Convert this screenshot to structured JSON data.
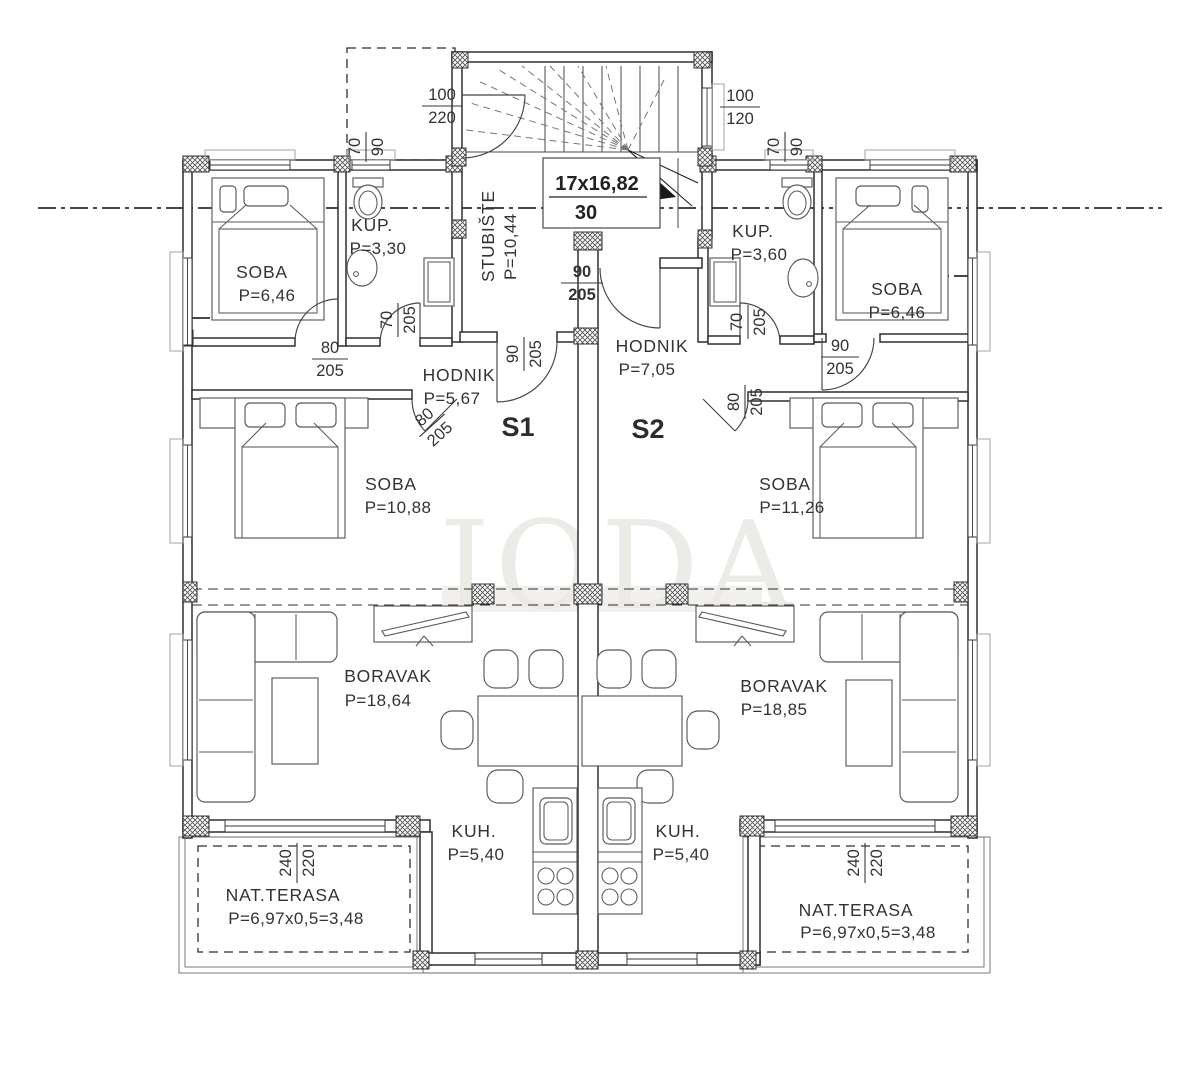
{
  "plan": {
    "watermark": "JODA",
    "stairwell": {
      "name": "STUBIŠTE",
      "area": "P=10,44",
      "steps": "17x16,82",
      "step_width": "30"
    },
    "unit1": {
      "id": "S1",
      "soba_small": {
        "name": "SOBA",
        "area": "P=6,46"
      },
      "kup": {
        "name": "KUP.",
        "area": "P=3,30"
      },
      "hodnik": {
        "name": "HODNIK",
        "area": "P=5,67"
      },
      "soba": {
        "name": "SOBA",
        "area": "P=10,88"
      },
      "boravak": {
        "name": "BORAVAK",
        "area": "P=18,64"
      },
      "kuh": {
        "name": "KUH.",
        "area": "P=5,40"
      },
      "terasa": {
        "name": "NAT.TERASA",
        "area": "P=6,97x0,5=3,48"
      }
    },
    "unit2": {
      "id": "S2",
      "kup": {
        "name": "KUP.",
        "area": "P=3,60"
      },
      "hodnik": {
        "name": "HODNIK",
        "area": "P=7,05"
      },
      "soba_small": {
        "name": "SOBA",
        "area": "P=6,46"
      },
      "soba": {
        "name": "SOBA",
        "area": "P=11,26"
      },
      "boravak": {
        "name": "BORAVAK",
        "area": "P=18,85"
      },
      "kuh": {
        "name": "KUH.",
        "area": "P=5,40"
      },
      "terasa": {
        "name": "NAT.TERASA",
        "area": "P=6,97x0,5=3,48"
      }
    },
    "dims": {
      "stair_door": {
        "w": "100",
        "h": "220"
      },
      "stair_window": {
        "w": "100",
        "h": "120"
      },
      "bath_window_left": {
        "w": "70",
        "h": "90"
      },
      "bath_window_right": {
        "w": "70",
        "h": "90"
      },
      "bath_door_left": {
        "w": "70",
        "h": "205"
      },
      "bath_door_right": {
        "w": "70",
        "h": "205"
      },
      "soba_small_door_left": {
        "w": "80",
        "h": "205"
      },
      "soba_door_left": {
        "w": "80",
        "h": "205"
      },
      "entry_s1": {
        "w": "90",
        "h": "205"
      },
      "entry_s2": {
        "w": "90",
        "h": "205"
      },
      "soba_small_door_right": {
        "w": "90",
        "h": "205"
      },
      "soba_door_right": {
        "w": "80",
        "h": "205"
      },
      "terrace_left": {
        "w": "240",
        "h": "220"
      },
      "terrace_right": {
        "w": "240",
        "h": "220"
      }
    }
  }
}
